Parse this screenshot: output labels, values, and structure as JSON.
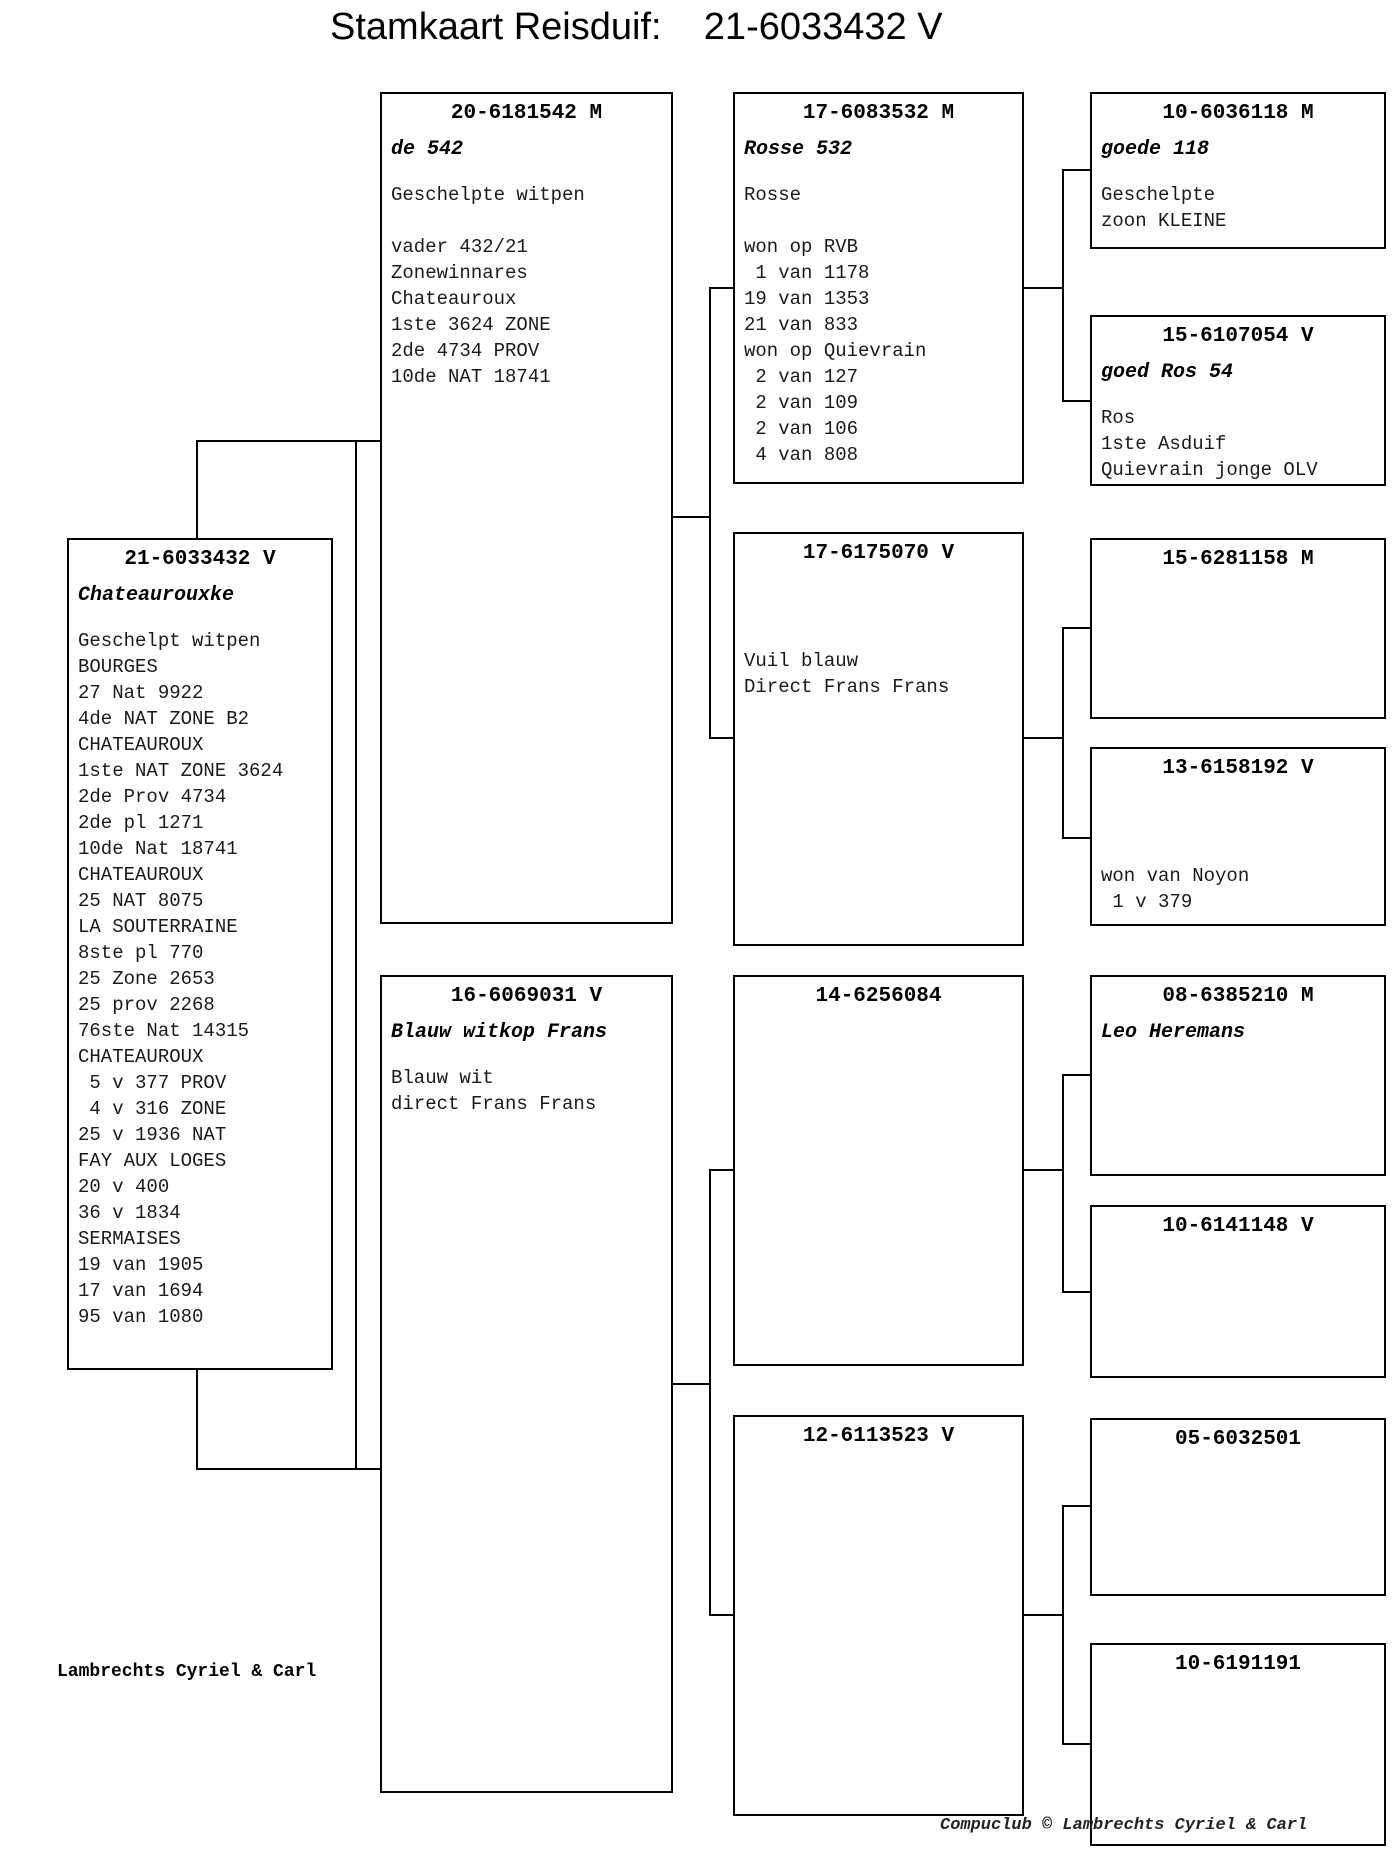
{
  "title": "Stamkaart Reisduif:    21-6033432 V",
  "footer": {
    "owner": "Lambrechts Cyriel & Carl",
    "credit": "Compuclub © Lambrechts Cyriel & Carl"
  },
  "boxes": {
    "subject": {
      "ring": "21-6033432 V",
      "name": "Chateaurouxke",
      "lines": [
        "Geschelpt witpen",
        "BOURGES",
        "27 Nat 9922",
        "4de NAT ZONE B2",
        "CHATEAUROUX",
        "1ste NAT ZONE 3624",
        "2de Prov 4734",
        "2de pl 1271",
        "10de Nat 18741",
        "CHATEAUROUX",
        "25 NAT 8075",
        "LA SOUTERRAINE",
        "8ste pl 770",
        "25 Zone 2653",
        "25 prov 2268",
        "76ste Nat 14315",
        "CHATEAUROUX",
        " 5 v 377 PROV",
        " 4 v 316 ZONE",
        "25 v 1936 NAT",
        "FAY AUX LOGES",
        "20 v 400",
        "36 v 1834",
        "SERMAISES",
        "19 van 1905",
        "17 van 1694",
        "95 van 1080"
      ]
    },
    "sire": {
      "ring": "20-6181542 M",
      "name": "de 542",
      "lines": [
        "Geschelpte witpen",
        "",
        "vader 432/21",
        "Zonewinnares",
        "Chateauroux",
        "1ste 3624 ZONE",
        "2de 4734 PROV",
        "10de NAT 18741"
      ]
    },
    "dam": {
      "ring": "16-6069031 V",
      "name": "Blauw witkop Frans",
      "lines": [
        "Blauw wit",
        "direct Frans Frans"
      ]
    },
    "sire_sire": {
      "ring": "17-6083532 M",
      "name": "Rosse 532",
      "lines": [
        "Rosse",
        "",
        "won op RVB",
        " 1 van 1178",
        "19 van 1353",
        "21 van 833",
        "won op Quievrain",
        " 2 van 127",
        " 2 van 109",
        " 2 van 106",
        " 4 van 808"
      ]
    },
    "sire_dam": {
      "ring": "17-6175070 V",
      "name": "",
      "lines": [
        "",
        "Vuil blauw",
        "Direct Frans Frans"
      ]
    },
    "dam_sire": {
      "ring": "14-6256084",
      "name": "",
      "lines": []
    },
    "dam_dam": {
      "ring": "12-6113523 V",
      "name": "",
      "lines": []
    },
    "ss_sire": {
      "ring": "10-6036118 M",
      "name": "goede 118",
      "lines": [
        "Geschelpte",
        "zoon KLEINE"
      ]
    },
    "ss_dam": {
      "ring": "15-6107054 V",
      "name": "goed Ros 54",
      "lines": [
        "Ros",
        "1ste Asduif",
        "Quievrain jonge OLV"
      ]
    },
    "sd_sire": {
      "ring": "15-6281158 M",
      "name": "",
      "lines": []
    },
    "sd_dam": {
      "ring": "13-6158192 V",
      "name": "",
      "lines": [
        "",
        "won van Noyon",
        " 1 v 379"
      ]
    },
    "ds_sire": {
      "ring": "08-6385210 M",
      "name": "Leo Heremans",
      "lines": []
    },
    "ds_dam": {
      "ring": "10-6141148 V",
      "name": "",
      "lines": []
    },
    "dd_sire": {
      "ring": "05-6032501",
      "name": "",
      "lines": []
    },
    "dd_dam": {
      "ring": "10-6191191",
      "name": "",
      "lines": []
    }
  }
}
